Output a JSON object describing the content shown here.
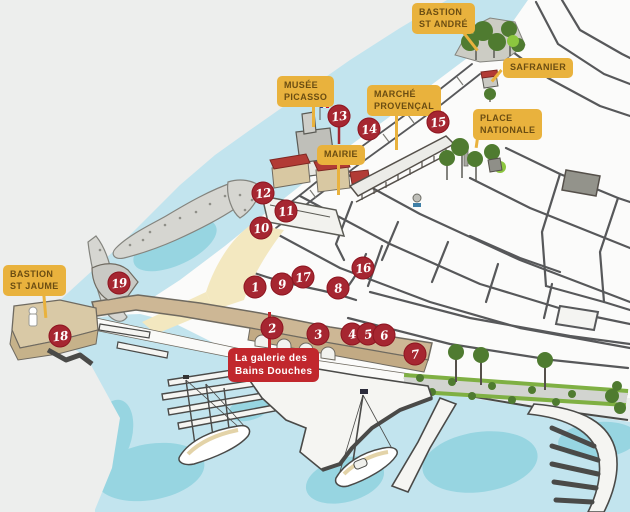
{
  "map": {
    "labels": [
      {
        "id": "bastion-st-andre",
        "kind": "yellow",
        "lines": [
          "BASTION",
          "ST ANDRÉ"
        ],
        "x": 412,
        "y": 3,
        "tail": {
          "x": 460,
          "y": 30,
          "len": 26,
          "angle": -38
        }
      },
      {
        "id": "safranier",
        "kind": "yellow",
        "lines": [
          "SAFRANIER"
        ],
        "x": 503,
        "y": 58,
        "tail": {
          "x": 500,
          "y": 70,
          "len": 15,
          "angle": 40
        }
      },
      {
        "id": "musee-picasso",
        "kind": "yellow",
        "lines": [
          "MUSÉE",
          "PICASSO"
        ],
        "x": 277,
        "y": 76,
        "tail": {
          "x": 312,
          "y": 100,
          "len": 27,
          "angle": 0
        }
      },
      {
        "id": "marche-provencal",
        "kind": "yellow",
        "lines": [
          "MARCHÉ",
          "PROVENÇAL"
        ],
        "x": 367,
        "y": 85,
        "tail": {
          "x": 395,
          "y": 110,
          "len": 40,
          "angle": 0
        }
      },
      {
        "id": "place-nationale",
        "kind": "yellow",
        "lines": [
          "PLACE",
          "NATIONALE"
        ],
        "x": 473,
        "y": 109,
        "tail": {
          "x": 477,
          "y": 131,
          "len": 17,
          "angle": 8
        }
      },
      {
        "id": "mairie",
        "kind": "yellow",
        "lines": [
          "MAIRIE"
        ],
        "x": 317,
        "y": 145,
        "tail": {
          "x": 337,
          "y": 160,
          "len": 35,
          "angle": 0
        }
      },
      {
        "id": "bastion-st-jaume",
        "kind": "yellow",
        "lines": [
          "BASTION",
          "ST JAUME"
        ],
        "x": 3,
        "y": 265,
        "tail": {
          "x": 42,
          "y": 291,
          "len": 27,
          "angle": -5
        }
      },
      {
        "id": "galerie-bains-douches",
        "kind": "red",
        "lines": [
          "La galerie des",
          "Bains Douches"
        ],
        "x": 228,
        "y": 348,
        "tail": {
          "x": 268,
          "y": 312,
          "len": 38,
          "angle": 0
        }
      }
    ],
    "markers": [
      {
        "number": "1",
        "x": 255,
        "y": 287
      },
      {
        "number": "2",
        "x": 272,
        "y": 328
      },
      {
        "number": "3",
        "x": 318,
        "y": 334
      },
      {
        "number": "4",
        "x": 352,
        "y": 334
      },
      {
        "number": "5",
        "x": 368,
        "y": 334
      },
      {
        "number": "6",
        "x": 384,
        "y": 335
      },
      {
        "number": "7",
        "x": 415,
        "y": 354
      },
      {
        "number": "8",
        "x": 338,
        "y": 288
      },
      {
        "number": "9",
        "x": 282,
        "y": 284
      },
      {
        "number": "10",
        "x": 261,
        "y": 228
      },
      {
        "number": "11",
        "x": 286,
        "y": 211
      },
      {
        "number": "12",
        "x": 263,
        "y": 193
      },
      {
        "number": "13",
        "x": 339,
        "y": 116
      },
      {
        "number": "14",
        "x": 369,
        "y": 129
      },
      {
        "number": "15",
        "x": 438,
        "y": 122
      },
      {
        "number": "16",
        "x": 363,
        "y": 268
      },
      {
        "number": "17",
        "x": 303,
        "y": 277
      },
      {
        "number": "18",
        "x": 60,
        "y": 336
      },
      {
        "number": "19",
        "x": 119,
        "y": 283
      }
    ],
    "colors": {
      "label_yellow": "#E9B23D",
      "label_yellow_text": "#6B4D12",
      "label_red": "#C1272D",
      "label_red_text": "#FFFFFF",
      "marker_red": "#A62631",
      "marker_text": "#FFFFFF",
      "water": "#C2E4EE",
      "water_deep": "#8FD2DE",
      "sand": "#F3E8C0",
      "land": "#EDEEED",
      "town": "#FBFBFA",
      "wall_tan": "#CDB795",
      "roof_red": "#B23B35",
      "tree_green": "#4F7B30",
      "tree_light": "#8CC63F",
      "street_gray": "#57585A"
    }
  }
}
